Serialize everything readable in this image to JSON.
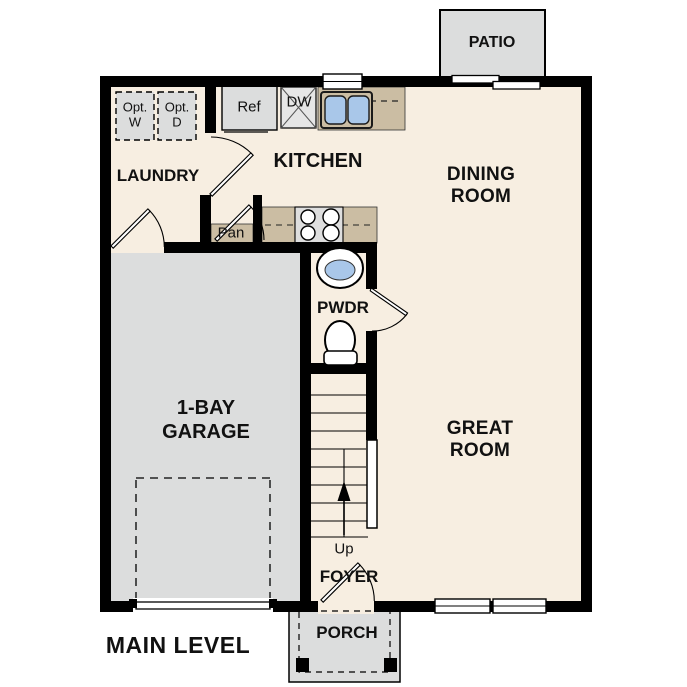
{
  "title": "MAIN LEVEL",
  "colors": {
    "floor": "#f7eee1",
    "hard_surface": "#dcdddd",
    "counter": "#cbbda3",
    "sink_water": "#a9c7e9",
    "wall": "#000000",
    "text": "#111111"
  },
  "rooms": {
    "patio": "PATIO",
    "laundry": "LAUNDRY",
    "kitchen": "KITCHEN",
    "dining_line1": "DINING",
    "dining_line2": "ROOM",
    "powder": "PWDR",
    "garage_line1": "1-BAY",
    "garage_line2": "GARAGE",
    "great_line1": "GREAT",
    "great_line2": "ROOM",
    "foyer": "FOYER",
    "porch": "PORCH"
  },
  "fixtures": {
    "refrigerator": "Ref",
    "dishwasher": "DW",
    "pantry": "Pan",
    "stairs_direction": "Up",
    "opt_washer_line1": "Opt.",
    "opt_washer_line2": "W",
    "opt_dryer_line1": "Opt.",
    "opt_dryer_line2": "D"
  }
}
